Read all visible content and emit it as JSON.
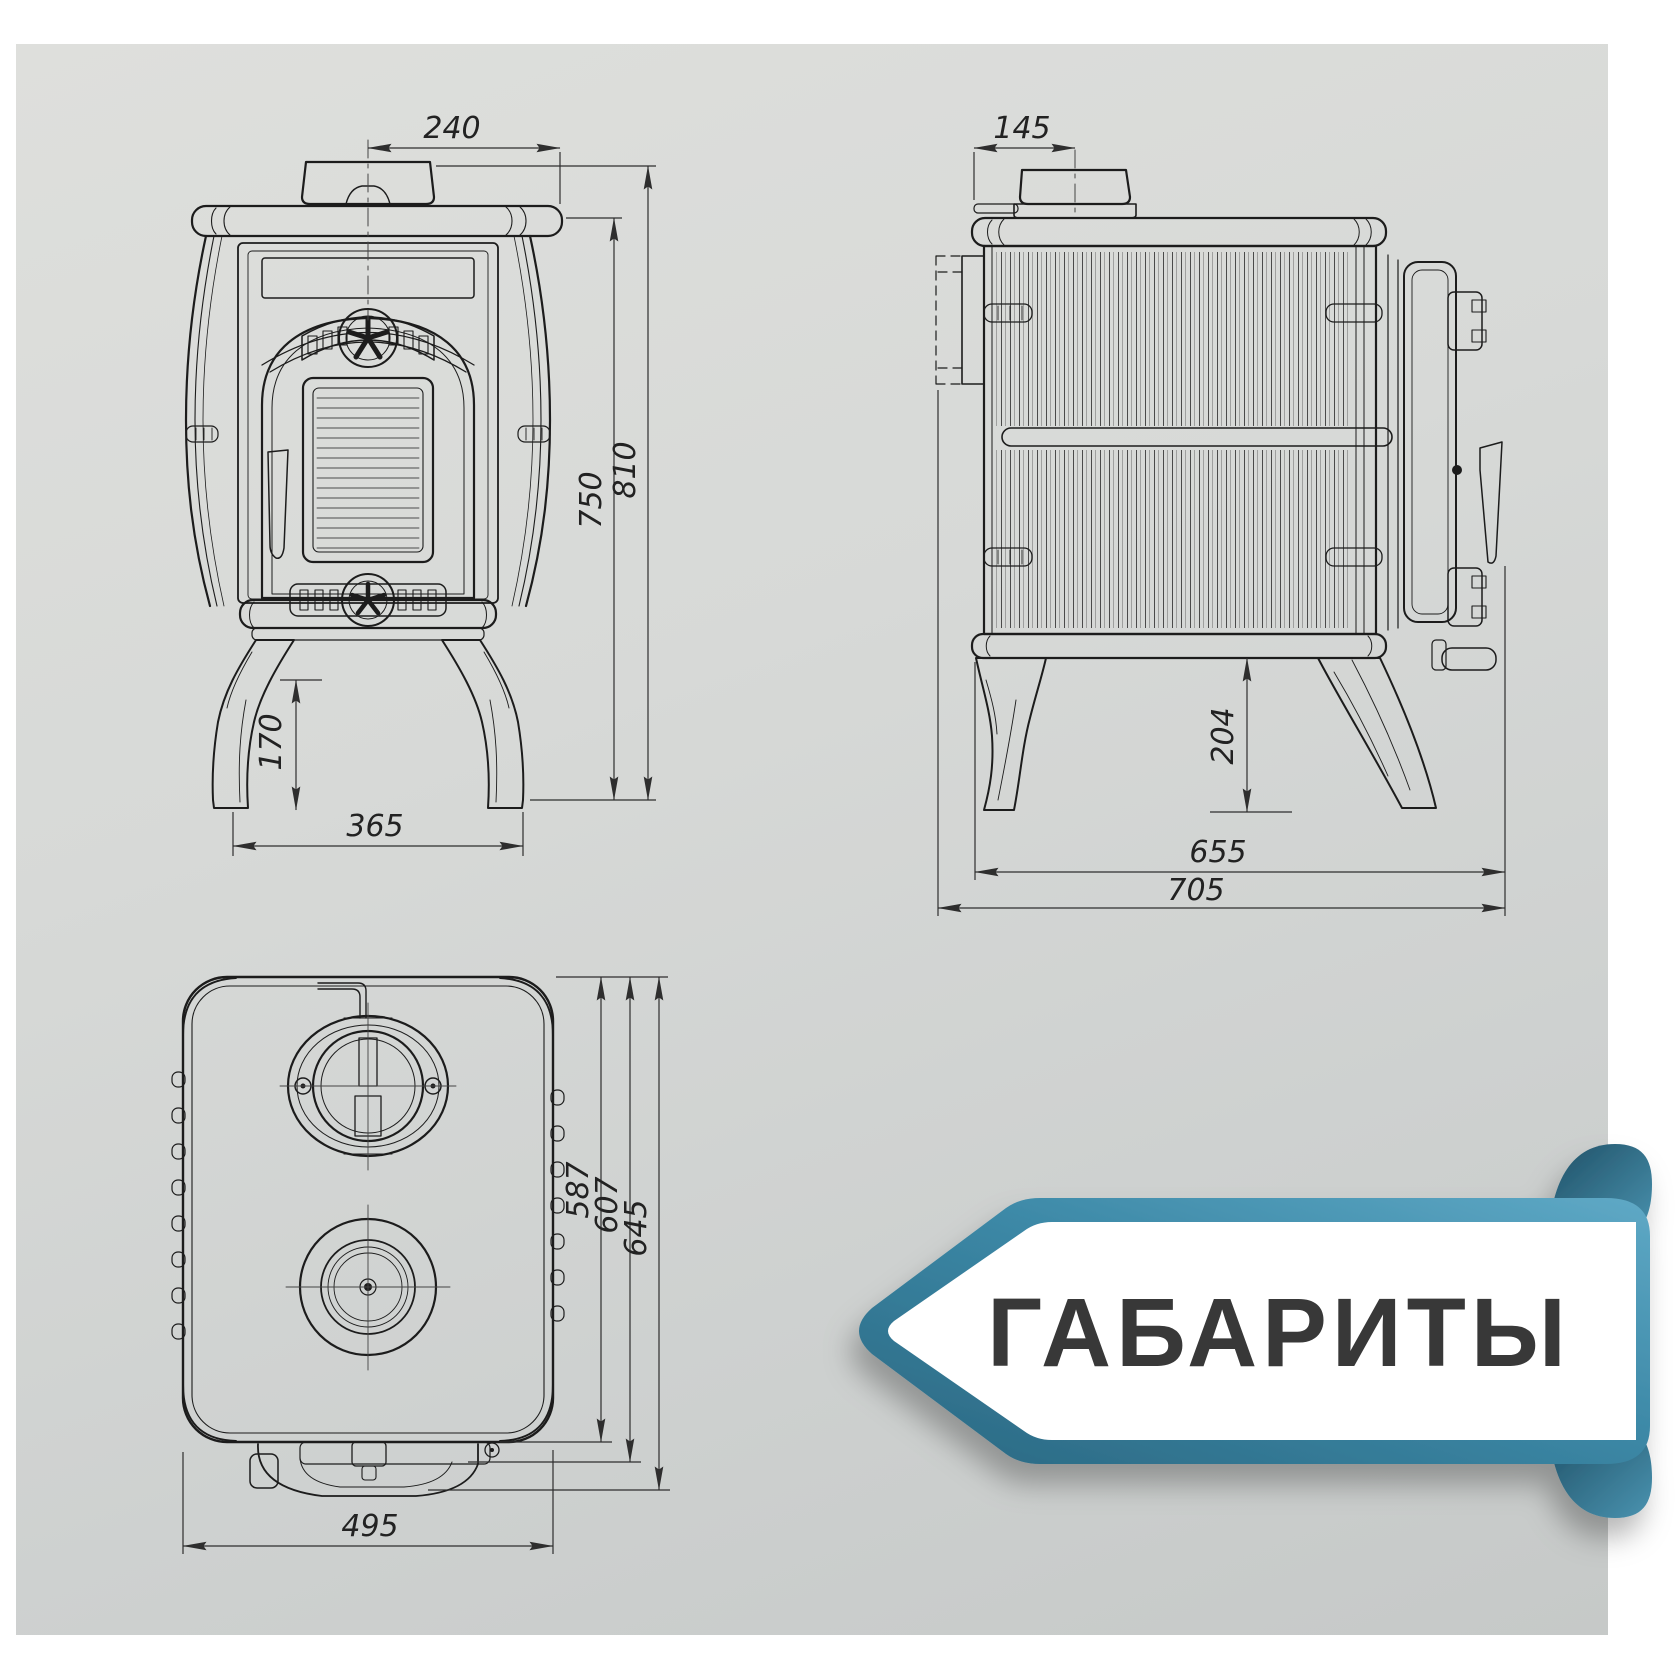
{
  "banner": {
    "title": "ГАБАРИТЫ"
  },
  "front_view": {
    "chimney_width": "240",
    "body_height": "750",
    "total_height": "810",
    "leg_height": "170",
    "base_width": "365"
  },
  "side_view": {
    "chimney_offset": "145",
    "leg_clearance": "204",
    "body_depth": "655",
    "total_depth": "705"
  },
  "top_view": {
    "body_depth": "587",
    "mid_depth": "607",
    "total_depth": "645",
    "width": "495"
  },
  "colors": {
    "accent_teal": "#3c88a6",
    "accent_teal_dark": "#2a6781",
    "line": "#1c1c1c",
    "title_text": "#383838",
    "background": "#d3d5d4"
  }
}
